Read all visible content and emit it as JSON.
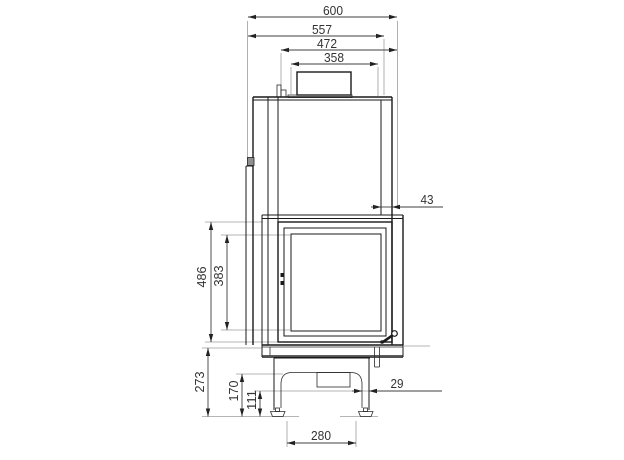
{
  "dimensions": {
    "top": {
      "d600": "600",
      "d557": "557",
      "d472": "472",
      "d358": "358"
    },
    "side": {
      "d43": "43",
      "d486": "486",
      "d383": "383"
    },
    "base": {
      "d273": "273",
      "d170": "170",
      "d111": "111",
      "d29": "29",
      "d280": "280"
    }
  },
  "colors": {
    "outline": "#1a1a1a",
    "dimension_line": "#3f3f3f",
    "extension_line": "#9c9c9c",
    "text": "#333333",
    "detail_fill": "#8f8f8f",
    "background": "#ffffff"
  }
}
